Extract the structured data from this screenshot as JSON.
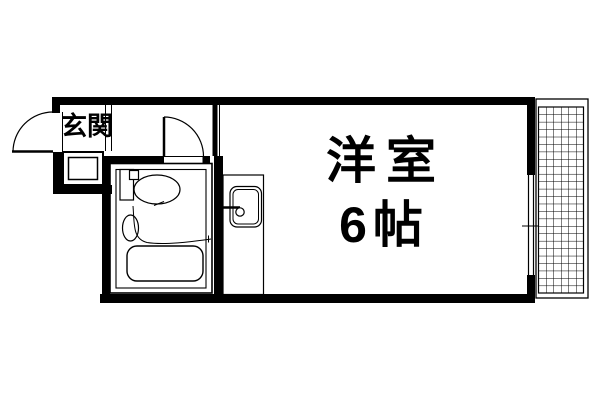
{
  "floor_plan": {
    "entrance": {
      "label": "玄関"
    },
    "main_room": {
      "name": "洋室",
      "size": "6帖"
    },
    "colors": {
      "wall": "#000000",
      "line": "#000000",
      "background": "#ffffff"
    },
    "fixtures": {
      "entrance_door": "outward-swing-door",
      "shoe_cabinet": "shoe-cabinet",
      "bathroom_door": "inward-swing-door",
      "toilet": "toilet",
      "hand_basin": "hand-basin",
      "bathtub": "bathtub",
      "kitchen_sink": "kitchen-sink-counter",
      "window": "sliding-window",
      "balcony": "balcony-hatched"
    }
  }
}
